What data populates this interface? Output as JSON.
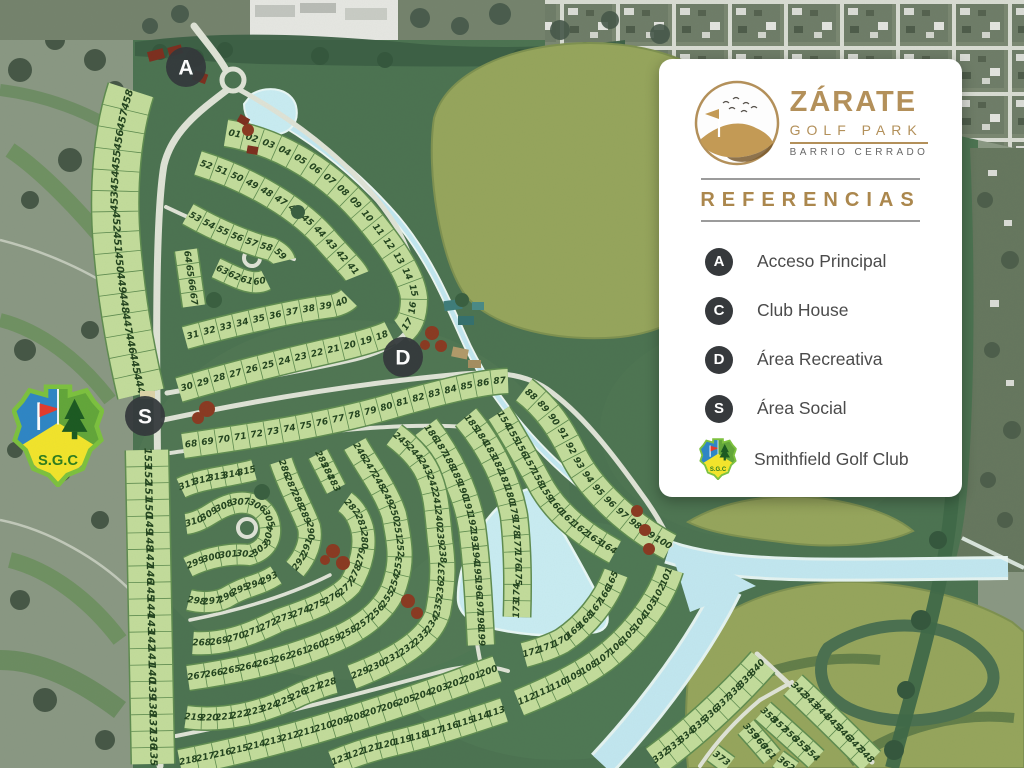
{
  "legend": {
    "logo": {
      "title": "ZÁRATE",
      "subtitle": "GOLF PARK",
      "tagline": "BARRIO CERRADO"
    },
    "heading": "REFERENCIAS",
    "items": [
      {
        "key": "A",
        "label": "Acceso Principal"
      },
      {
        "key": "C",
        "label": "Club House"
      },
      {
        "key": "D",
        "label": "Área Recreativa"
      },
      {
        "key": "S",
        "label": "Área Social"
      }
    ],
    "club": {
      "label": "Smithfield Golf Club",
      "initials": "S.G.C"
    }
  },
  "colors": {
    "parcel_fill": "#c3dc9b",
    "parcel_border": "#5f8c50",
    "lot_text": "#23441f",
    "badge": "#34383b",
    "road": "#dfe3d6",
    "water": "#c2e7f0",
    "estate": "#4c7351",
    "olive": "#96a55c",
    "gold": "#b3905a"
  },
  "map": {
    "markers": [
      {
        "key": "A",
        "x": 186,
        "y": 67
      },
      {
        "key": "D",
        "x": 403,
        "y": 357
      },
      {
        "key": "S",
        "x": 145,
        "y": 416
      }
    ],
    "lot_rows": [
      {
        "id": "col-upper",
        "w": 46,
        "fs": 10,
        "path": "M131,90 C118,130 112,185 117,245 C122,305 131,352 141,394",
        "numbers": [
          "458",
          "457",
          "456",
          "455",
          "454",
          "453",
          "452",
          "451",
          "450",
          "449",
          "448",
          "447",
          "446",
          "445",
          "444"
        ]
      },
      {
        "id": "col-lower",
        "w": 42,
        "fs": 10,
        "path": "M147,450 L153,764",
        "numbers": [
          "153",
          "152",
          "151",
          "150",
          "149",
          "148",
          "147",
          "146",
          "145",
          "144",
          "143",
          "142",
          "141",
          "140",
          "139",
          "138",
          "137",
          "136",
          "135"
        ]
      },
      {
        "id": "ring-top",
        "w": 26,
        "path": "M226,133 C282,142 334,176 368,218 C396,252 412,278 414,298 C414,316 409,326 402,331",
        "numbers": [
          "01",
          "02",
          "03",
          "04",
          "05",
          "06",
          "07",
          "08",
          "09",
          "10",
          "11",
          "12",
          "13",
          "14",
          "15",
          "16",
          "17"
        ]
      },
      {
        "id": "ring-top-return",
        "w": 24,
        "path": "M179,390 C240,372 302,357 342,348 C366,342 382,337 390,333",
        "numbers": [
          "30",
          "29",
          "28",
          "27",
          "26",
          "25",
          "24",
          "23",
          "22",
          "21",
          "20",
          "19",
          "18"
        ]
      },
      {
        "id": "ring-2",
        "w": 24,
        "path": "M198,163 C252,180 302,210 328,242 C346,262 355,271 357,276",
        "numbers": [
          "52",
          "51",
          "50",
          "49",
          "48",
          "47",
          "46",
          "45",
          "44",
          "43",
          "42",
          "41"
        ]
      },
      {
        "id": "ring-2-return",
        "w": 22,
        "path": "M185,338 C232,325 292,311 332,306 C341,304 346,301 349,298",
        "numbers": [
          "31",
          "32",
          "33",
          "34",
          "35",
          "36",
          "37",
          "38",
          "39",
          "40"
        ]
      },
      {
        "id": "row-53",
        "w": 22,
        "path": "M188,214 C220,232 250,244 271,249 C279,253 283,257 284,261",
        "numbers": [
          "53",
          "54",
          "55",
          "56",
          "57",
          "58",
          "59"
        ]
      },
      {
        "id": "row-60",
        "w": 20,
        "path": "M216,268 C236,277 252,287 266,280",
        "numbers": [
          "63",
          "62",
          "61",
          "60"
        ]
      },
      {
        "id": "row-64",
        "w": 22,
        "path": "M186,250 L194,306",
        "numbers": [
          "64",
          "65",
          "66",
          "67"
        ]
      },
      {
        "id": "row-68",
        "w": 24,
        "path": "M183,446 C252,436 334,424 402,403 C442,392 480,382 508,381",
        "numbers": [
          "68",
          "69",
          "70",
          "71",
          "72",
          "73",
          "74",
          "75",
          "76",
          "77",
          "78",
          "79",
          "80",
          "81",
          "82",
          "83",
          "84",
          "85",
          "86",
          "87"
        ]
      },
      {
        "id": "row-88",
        "w": 26,
        "path": "M524,390 C548,408 561,430 572,452 C591,492 632,527 670,547",
        "numbers": [
          "88",
          "89",
          "90",
          "91",
          "92",
          "93",
          "94",
          "95",
          "96",
          "97",
          "98",
          "99",
          "100"
        ]
      },
      {
        "id": "row-101",
        "w": 26,
        "path": "M670,569 C660,601 631,641 596,664 C571,681 541,694 519,703",
        "numbers": [
          "101",
          "102",
          "103",
          "104",
          "105",
          "106",
          "107",
          "108",
          "109",
          "110",
          "111",
          "112"
        ]
      },
      {
        "id": "row-113",
        "w": 24,
        "path": "M504,710 C468,722 430,735 391,744 C370,749 350,756 333,763",
        "numbers": [
          "113",
          "114",
          "115",
          "116",
          "117",
          "118",
          "119",
          "120",
          "121",
          "122",
          "123"
        ]
      },
      {
        "id": "row-154",
        "w": 24,
        "path": "M499,413 C515,438 528,462 543,489 C560,517 586,536 615,552",
        "numbers": [
          "154",
          "155",
          "156",
          "157",
          "158",
          "159",
          "160",
          "161",
          "162",
          "163",
          "164"
        ]
      },
      {
        "id": "row-165",
        "w": 24,
        "path": "M616,573 C605,602 585,626 562,641 C549,648 535,652 524,655",
        "numbers": [
          "165",
          "166",
          "167",
          "168",
          "169",
          "170",
          "171",
          "172"
        ]
      },
      {
        "id": "row-173",
        "w": 26,
        "path": "M466,417 C491,447 508,482 514,516 C518,550 518,585 517,617",
        "numbers": [
          "185",
          "184",
          "183",
          "182",
          "181",
          "180",
          "179",
          "178",
          "177",
          "176",
          "175",
          "174",
          "173"
        ]
      },
      {
        "id": "row-186",
        "w": 26,
        "path": "M426,427 C449,457 466,492 472,527 C477,565 479,606 481,645",
        "numbers": [
          "186",
          "187",
          "188",
          "189",
          "190",
          "191",
          "192",
          "193",
          "194",
          "195",
          "196",
          "197",
          "198",
          "199"
        ]
      },
      {
        "id": "row-200",
        "w": 26,
        "path": "M180,763 C262,747 332,726 392,706 C432,693 466,680 497,669",
        "numbers": [
          "218",
          "217",
          "216",
          "215",
          "214",
          "213",
          "212",
          "211",
          "210",
          "209",
          "208",
          "207",
          "206",
          "205",
          "204",
          "203",
          "202",
          "201",
          "200"
        ]
      },
      {
        "id": "row-219",
        "w": 22,
        "path": "M186,717 C220,722 262,714 301,694 C316,688 326,684 335,682",
        "numbers": [
          "219",
          "220",
          "221",
          "222",
          "223",
          "224",
          "225",
          "226",
          "227",
          "228"
        ]
      },
      {
        "id": "row-229",
        "w": 24,
        "path": "M352,677 C396,660 430,640 438,612 C444,580 443,560 440,540 C437,510 436,494 430,479 C424,461 410,447 394,435",
        "numbers": [
          "229",
          "230",
          "231",
          "232",
          "233",
          "234",
          "235",
          "236",
          "237",
          "238",
          "239",
          "240",
          "241",
          "242",
          "243",
          "244",
          "245"
        ]
      },
      {
        "id": "row-246",
        "w": 24,
        "path": "M355,444 C366,464 386,490 394,515 C400,544 402,560 396,580 C390,605 370,622 345,635 C310,652 260,668 188,678",
        "numbers": [
          "246",
          "247",
          "248",
          "249",
          "250",
          "251",
          "252",
          "253",
          "254",
          "255",
          "256",
          "257",
          "258",
          "259",
          "260",
          "261",
          "262",
          "263",
          "264",
          "265",
          "266",
          "267"
        ]
      },
      {
        "id": "row-268",
        "w": 22,
        "path": "M193,643 C220,645 246,637 280,620 C310,610 336,600 350,585 C362,565 366,545 362,528 C358,514 352,507 345,502",
        "numbers": [
          "268",
          "269",
          "270",
          "271",
          "272",
          "273",
          "274",
          "275",
          "276",
          "277",
          "278",
          "279",
          "280",
          "281",
          "282"
        ]
      },
      {
        "id": "row-283",
        "w": 20,
        "path": "M336,489 L318,454",
        "numbers": [
          "283",
          "284",
          "285"
        ]
      },
      {
        "id": "row-286",
        "w": 22,
        "path": "M281,461 C289,486 301,506 309,527 C312,541 306,556 295,569",
        "numbers": [
          "286",
          "287",
          "288",
          "289",
          "290",
          "291",
          "292"
        ]
      },
      {
        "id": "row-293",
        "w": 20,
        "path": "M276,575 C259,586 245,586 229,596 C220,602 204,604 189,600",
        "numbers": [
          "293",
          "294",
          "295",
          "296",
          "297",
          "298"
        ]
      },
      {
        "id": "row-299",
        "w": 20,
        "path": "M188,567 C208,557 232,553 249,555 C264,551 271,541 270,528 C269,514 260,505 247,503 C233,501 220,508 209,515 C201,520 194,523 186,524",
        "numbers": [
          "299",
          "300",
          "301",
          "302",
          "303",
          "304",
          "305",
          "306",
          "307",
          "308",
          "309",
          "310"
        ]
      },
      {
        "id": "row-311",
        "w": 20,
        "path": "M181,488 C202,478 228,477 254,470",
        "numbers": [
          "311",
          "312",
          "313",
          "314",
          "315"
        ]
      },
      {
        "id": "row-332",
        "w": 30,
        "path": "M655,761 C688,737 729,701 763,662",
        "numbers": [
          "332",
          "333",
          "334",
          "335",
          "336",
          "337",
          "338",
          "339",
          "340"
        ]
      },
      {
        "id": "row-342",
        "w": 26,
        "path": "M793,685 C820,710 846,736 871,761",
        "numbers": [
          "342",
          "343",
          "344",
          "345",
          "346",
          "347",
          "348"
        ]
      },
      {
        "id": "row-358",
        "w": 22,
        "path": "M763,711 C781,727 799,743 816,759",
        "numbers": [
          "358",
          "357",
          "356",
          "355",
          "354"
        ]
      },
      {
        "id": "row-359",
        "w": 20,
        "path": "M746,727 C755,737 764,747 772,757",
        "numbers": [
          "359",
          "360",
          "361"
        ]
      },
      {
        "id": "row-373",
        "w": 18,
        "path": "M713,753 L729,765",
        "numbers": [
          "373"
        ]
      },
      {
        "id": "row-362",
        "w": 18,
        "path": "M778,759 L793,770",
        "numbers": [
          "362"
        ]
      }
    ]
  }
}
